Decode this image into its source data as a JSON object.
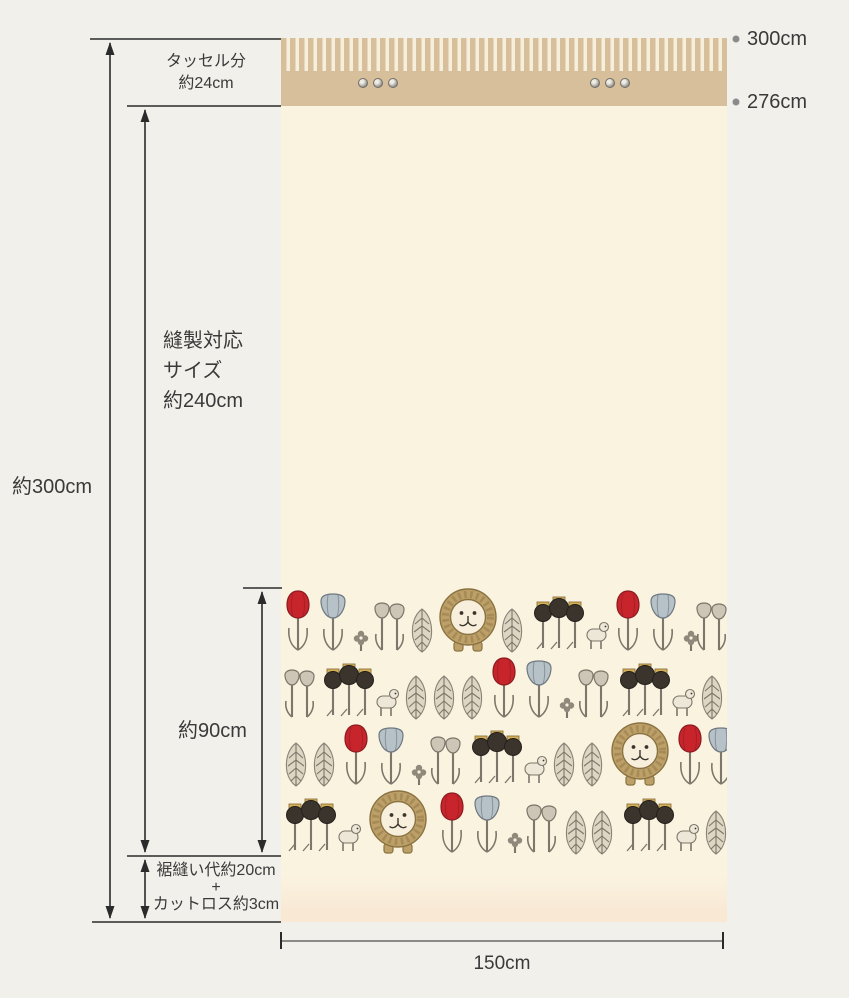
{
  "labels": {
    "tassel": {
      "line1": "タッセル分",
      "line2": "約24cm"
    },
    "sewing": {
      "line1": "縫製対応",
      "line2": "サイズ",
      "line3": "約240cm"
    },
    "total_height": "約300cm",
    "pattern_height": "約90cm",
    "hem": {
      "line1": "裾縫い代約20cm",
      "line2": "+",
      "line3": "カットロス約3cm"
    },
    "right_top": "300cm",
    "right_middle": "276cm",
    "fabric_width": "150cm"
  },
  "colors": {
    "background": "#f1f0eb",
    "fabric_body": "#faf3e0",
    "band_tan": "#d8bf9b",
    "stripe_cream": "#f6efdb",
    "hem_tint": "#f8e8d4",
    "line": "#2b2b2b",
    "width_line": "#8a8a86",
    "bullet": "#8b8b8b",
    "text": "#3a3a3a",
    "motif_red": "#c8242b",
    "motif_blue": "#b7c1c8",
    "motif_dark": "#3a342d",
    "motif_gray": "#7d766a",
    "lion_mane": "#bd9f68",
    "lion_face": "#f7efdc",
    "crown_gold": "#d6b057"
  },
  "fabric": {
    "hook_groups": [
      {
        "x": 77,
        "y": 7,
        "count": 3,
        "spacing": 15
      },
      {
        "x": 309,
        "y": 7,
        "count": 3,
        "spacing": 15
      }
    ],
    "pattern_rows": [
      {
        "motifs": [
          [
            "tulip_red",
            2,
            2
          ],
          [
            "tulip_blue",
            36,
            6
          ],
          [
            "clover",
            72,
            42
          ],
          [
            "tulip_gray",
            90,
            14
          ],
          [
            "leaf",
            128,
            20
          ],
          [
            "lion",
            156,
            0
          ],
          [
            "leaf",
            218,
            20
          ],
          [
            "dark_cluster",
            248,
            8
          ],
          [
            "tulip_red",
            332,
            2
          ],
          [
            "tulip_blue",
            366,
            6
          ],
          [
            "clover",
            402,
            42
          ],
          [
            "tulip_gray",
            412,
            14
          ]
        ]
      },
      {
        "motifs": [
          [
            "tulip_gray",
            0,
            81
          ],
          [
            "dark_cluster",
            38,
            75
          ],
          [
            "leaf",
            122,
            87
          ],
          [
            "leaf",
            150,
            87
          ],
          [
            "leaf",
            178,
            87
          ],
          [
            "tulip_red",
            208,
            69
          ],
          [
            "tulip_blue",
            242,
            73
          ],
          [
            "clover",
            278,
            109
          ],
          [
            "tulip_gray",
            294,
            81
          ],
          [
            "dark_cluster",
            334,
            75
          ],
          [
            "leaf",
            418,
            87
          ]
        ]
      },
      {
        "motifs": [
          [
            "leaf",
            2,
            154
          ],
          [
            "leaf",
            30,
            154
          ],
          [
            "tulip_red",
            60,
            136
          ],
          [
            "tulip_blue",
            94,
            140
          ],
          [
            "clover",
            130,
            176
          ],
          [
            "tulip_gray",
            146,
            148
          ],
          [
            "dark_cluster",
            186,
            142
          ],
          [
            "leaf",
            270,
            154
          ],
          [
            "leaf",
            298,
            154
          ],
          [
            "lion",
            328,
            134
          ],
          [
            "tulip_red",
            394,
            136
          ],
          [
            "tulip_blue",
            424,
            140
          ]
        ]
      },
      {
        "motifs": [
          [
            "dark_cluster",
            0,
            210
          ],
          [
            "lion",
            86,
            202
          ],
          [
            "tulip_red",
            156,
            204
          ],
          [
            "tulip_blue",
            190,
            208
          ],
          [
            "clover",
            226,
            244
          ],
          [
            "tulip_gray",
            242,
            216
          ],
          [
            "leaf",
            282,
            222
          ],
          [
            "leaf",
            308,
            222
          ],
          [
            "dark_cluster",
            338,
            210
          ],
          [
            "leaf",
            422,
            222
          ]
        ]
      }
    ]
  }
}
